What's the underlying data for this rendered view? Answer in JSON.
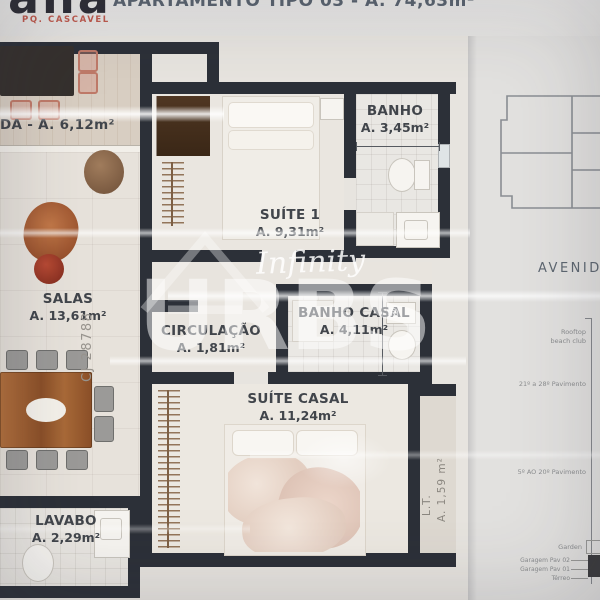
{
  "header": {
    "logo_text": "ana",
    "logo_subtitle": "PQ. CASCAVEL",
    "title": "APARTAMENTO TIPO 03 - A. 74,63m²"
  },
  "rooms": {
    "varanda": {
      "label": "DA - A.  6,12m²"
    },
    "suite1": {
      "name": "SUÍTE 1",
      "area": "A. 9,31m²"
    },
    "banho": {
      "name": "BANHO",
      "area": "A. 3,45m²"
    },
    "salas": {
      "name": "SALAS",
      "area": "A. 13,61m²"
    },
    "circulacao": {
      "name": "CIRCULAÇÃO",
      "area": "A. 1,81m²"
    },
    "banho_casal": {
      "name": "BANHO CASAL",
      "area": "A. 4,11m²"
    },
    "suite_casal": {
      "name": "SUÍTE CASAL",
      "area": "A. 11,24m²"
    },
    "lavabo": {
      "name": "LAVABO",
      "area": "A. 2,29m²"
    },
    "lt": {
      "name": "L.T.",
      "area": "A. 1,59 m²"
    }
  },
  "watermark": {
    "script_text": "Infinity",
    "brand_text": "URBS",
    "registered_mark": "®",
    "license_text": "CJ 28788"
  },
  "side_panel": {
    "street_label": "AVENIDA F",
    "tower_section": {
      "rooftop_label": "Rooftop beach club",
      "upper_floors_label": "21º a 28º Pavimento",
      "mid_floors_label": "5º AO 20º Pavimento",
      "garden_label": "Garden",
      "garage2_label": "Garagem Pav 02",
      "garage1_label": "Garagem Pav 01",
      "ground_label": "Térreo"
    }
  },
  "colors": {
    "wall": "#2c3038",
    "accent_red": "#c05a4d",
    "watermark_white": "rgba(255,255,255,0.6)",
    "floor_beige": "#e9e5df"
  }
}
